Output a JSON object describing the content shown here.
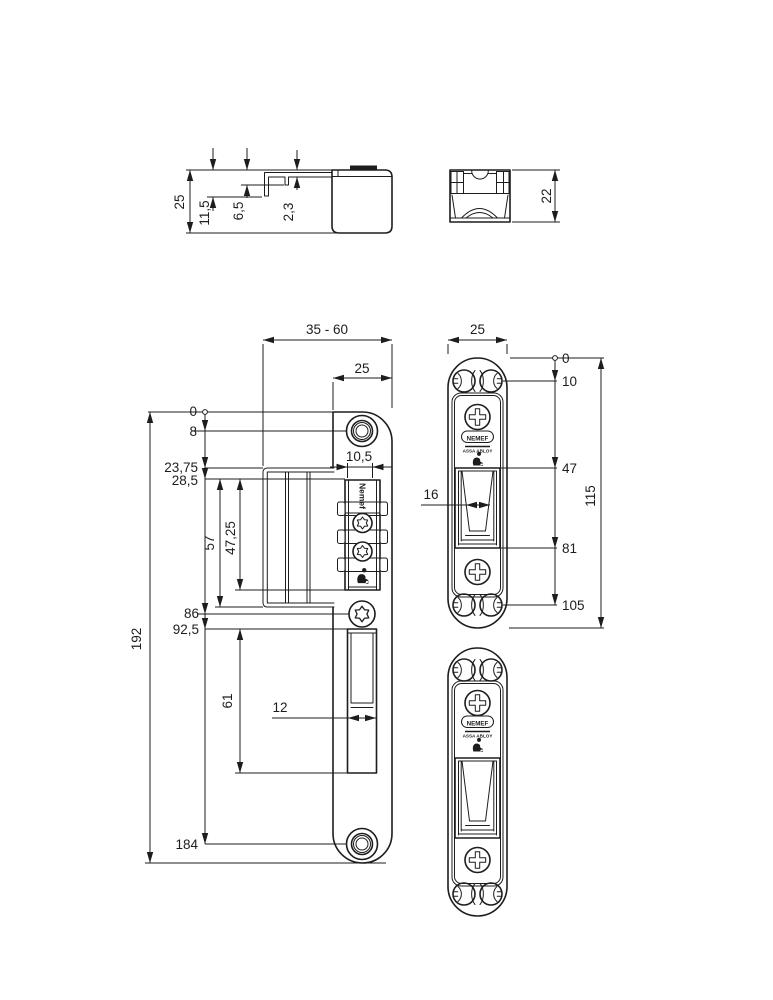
{
  "drawing": {
    "bg_color": "#ffffff",
    "line_color": "#1d1d1d",
    "views": {
      "side_profile": {
        "dims": {
          "total_height": "25",
          "lip_depth": "11,5",
          "mid_step": "6,5",
          "lip_offset": "2,3"
        }
      },
      "housing_section": {
        "dims": {
          "height": "22"
        }
      },
      "front": {
        "dims": {
          "backset_range": "35 - 60",
          "head_width": "25",
          "terminal_width": "10,5",
          "origin": "0",
          "top_screw": "8",
          "lip_top": "23,75",
          "box_top": "28,5",
          "lip_span": "57",
          "box_span": "47,25",
          "lip_bottom": "86",
          "pocket_top": "92,5",
          "pocket_span": "61",
          "pocket_width": "12",
          "bottom_screw": "184",
          "total_length": "192"
        },
        "brand_vertical": "Nemef"
      },
      "faceplate_dimensioned": {
        "dims": {
          "width": "25",
          "origin": "0",
          "slot_top": "10",
          "keeper_width": "16",
          "keeper_top": "47",
          "keeper_bottom": "81",
          "slot_bottom": "105",
          "total_length": "115"
        },
        "logo": "NEMEF",
        "logo_sub": "ASSA ABLOY"
      },
      "faceplate_plain": {
        "logo": "NEMEF",
        "logo_sub": "ASSA ABLOY"
      }
    },
    "icons": {
      "torx_screw": "torx-screw-icon",
      "phillips_screw": "phillips-screw-icon",
      "skg_mark": "skg-certification-icon",
      "origin_marker": "origin-circle-icon"
    }
  }
}
